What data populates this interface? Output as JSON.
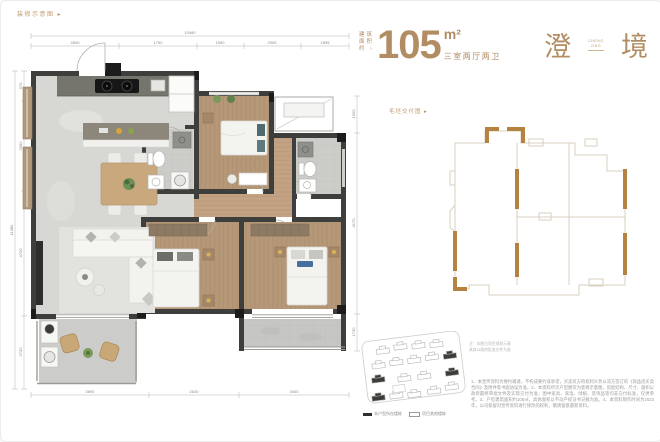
{
  "top_label": "装修示意图 ▸",
  "spec": {
    "prefix_line1": "建筑",
    "prefix_line2": "面积",
    "prefix_line3": "约 ›",
    "area_value": "105",
    "area_unit": "m²",
    "layout": "三室两厅两卫",
    "accent_color": "#b28d63"
  },
  "title": {
    "first": "澄",
    "sub_line1": "CHENG",
    "sub_line2": "JING",
    "last": "境"
  },
  "delivery": {
    "label": "毛坯交付图 ▸",
    "outline_color": "#d8d0c0",
    "highlight_color": "#b5823f"
  },
  "plan": {
    "wall_color": "#3e3e3c",
    "dims_top": [
      "2840",
      "1750",
      "1590",
      "2905",
      "1895"
    ],
    "dims_top_total": "10980",
    "dims_left": [
      "970",
      "2980",
      "4700",
      "2730"
    ],
    "dims_left_total": "11380",
    "dims_bottom": [
      "3690",
      "2630",
      "3400"
    ],
    "dims_right": [
      "1000",
      "4170",
      "1730"
    ]
  },
  "site": {
    "legend_item1": "本户型所在楼栋",
    "legend_item2": "项目其他楼栋",
    "note_line1": "注：本图为项目规划示意",
    "note_line2": "具体以政府批准文件为准"
  },
  "disclaimer": "1、本宣传资料为要约邀请，不构成要约或承诺，买卖双方的权利义务以双方签订的《商品房买卖合同》及附件等书面协议为准。2、本资料所示户型图仅为装修示意图，房屋结构、尺寸、面积以政府最终审批文件及实际交付为准；图中家具、家电、绿植、装饰品等均非交付标准，仅供参考。3、户型建筑面积约105㎡，具体面积以不动产权证书记载为准。4、本资料制作时间为2023年，公司保留对宣传资料进行修改的权利，敬请留意最新资料。"
}
